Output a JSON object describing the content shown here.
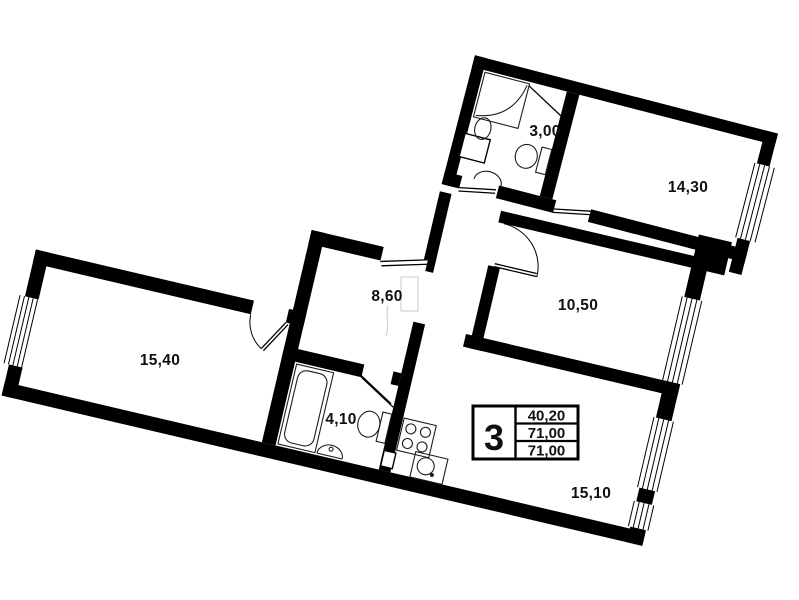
{
  "rooms": {
    "shower_room": {
      "area": "3,00"
    },
    "bedroom": {
      "area": "14,30"
    },
    "hallway": {
      "area": "8,60"
    },
    "room_middle": {
      "area": "10,50"
    },
    "room_left": {
      "area": "15,40"
    },
    "bathroom": {
      "area": "4,10"
    },
    "kitchen_living": {
      "area": "15,10"
    }
  },
  "stamp": {
    "rooms_count": "3",
    "living_area": "40,20",
    "total_area": "71,00",
    "total_with_summer": "71,00"
  },
  "colors": {
    "walls": "#000000",
    "background": "#ffffff",
    "labels": "#111111"
  }
}
